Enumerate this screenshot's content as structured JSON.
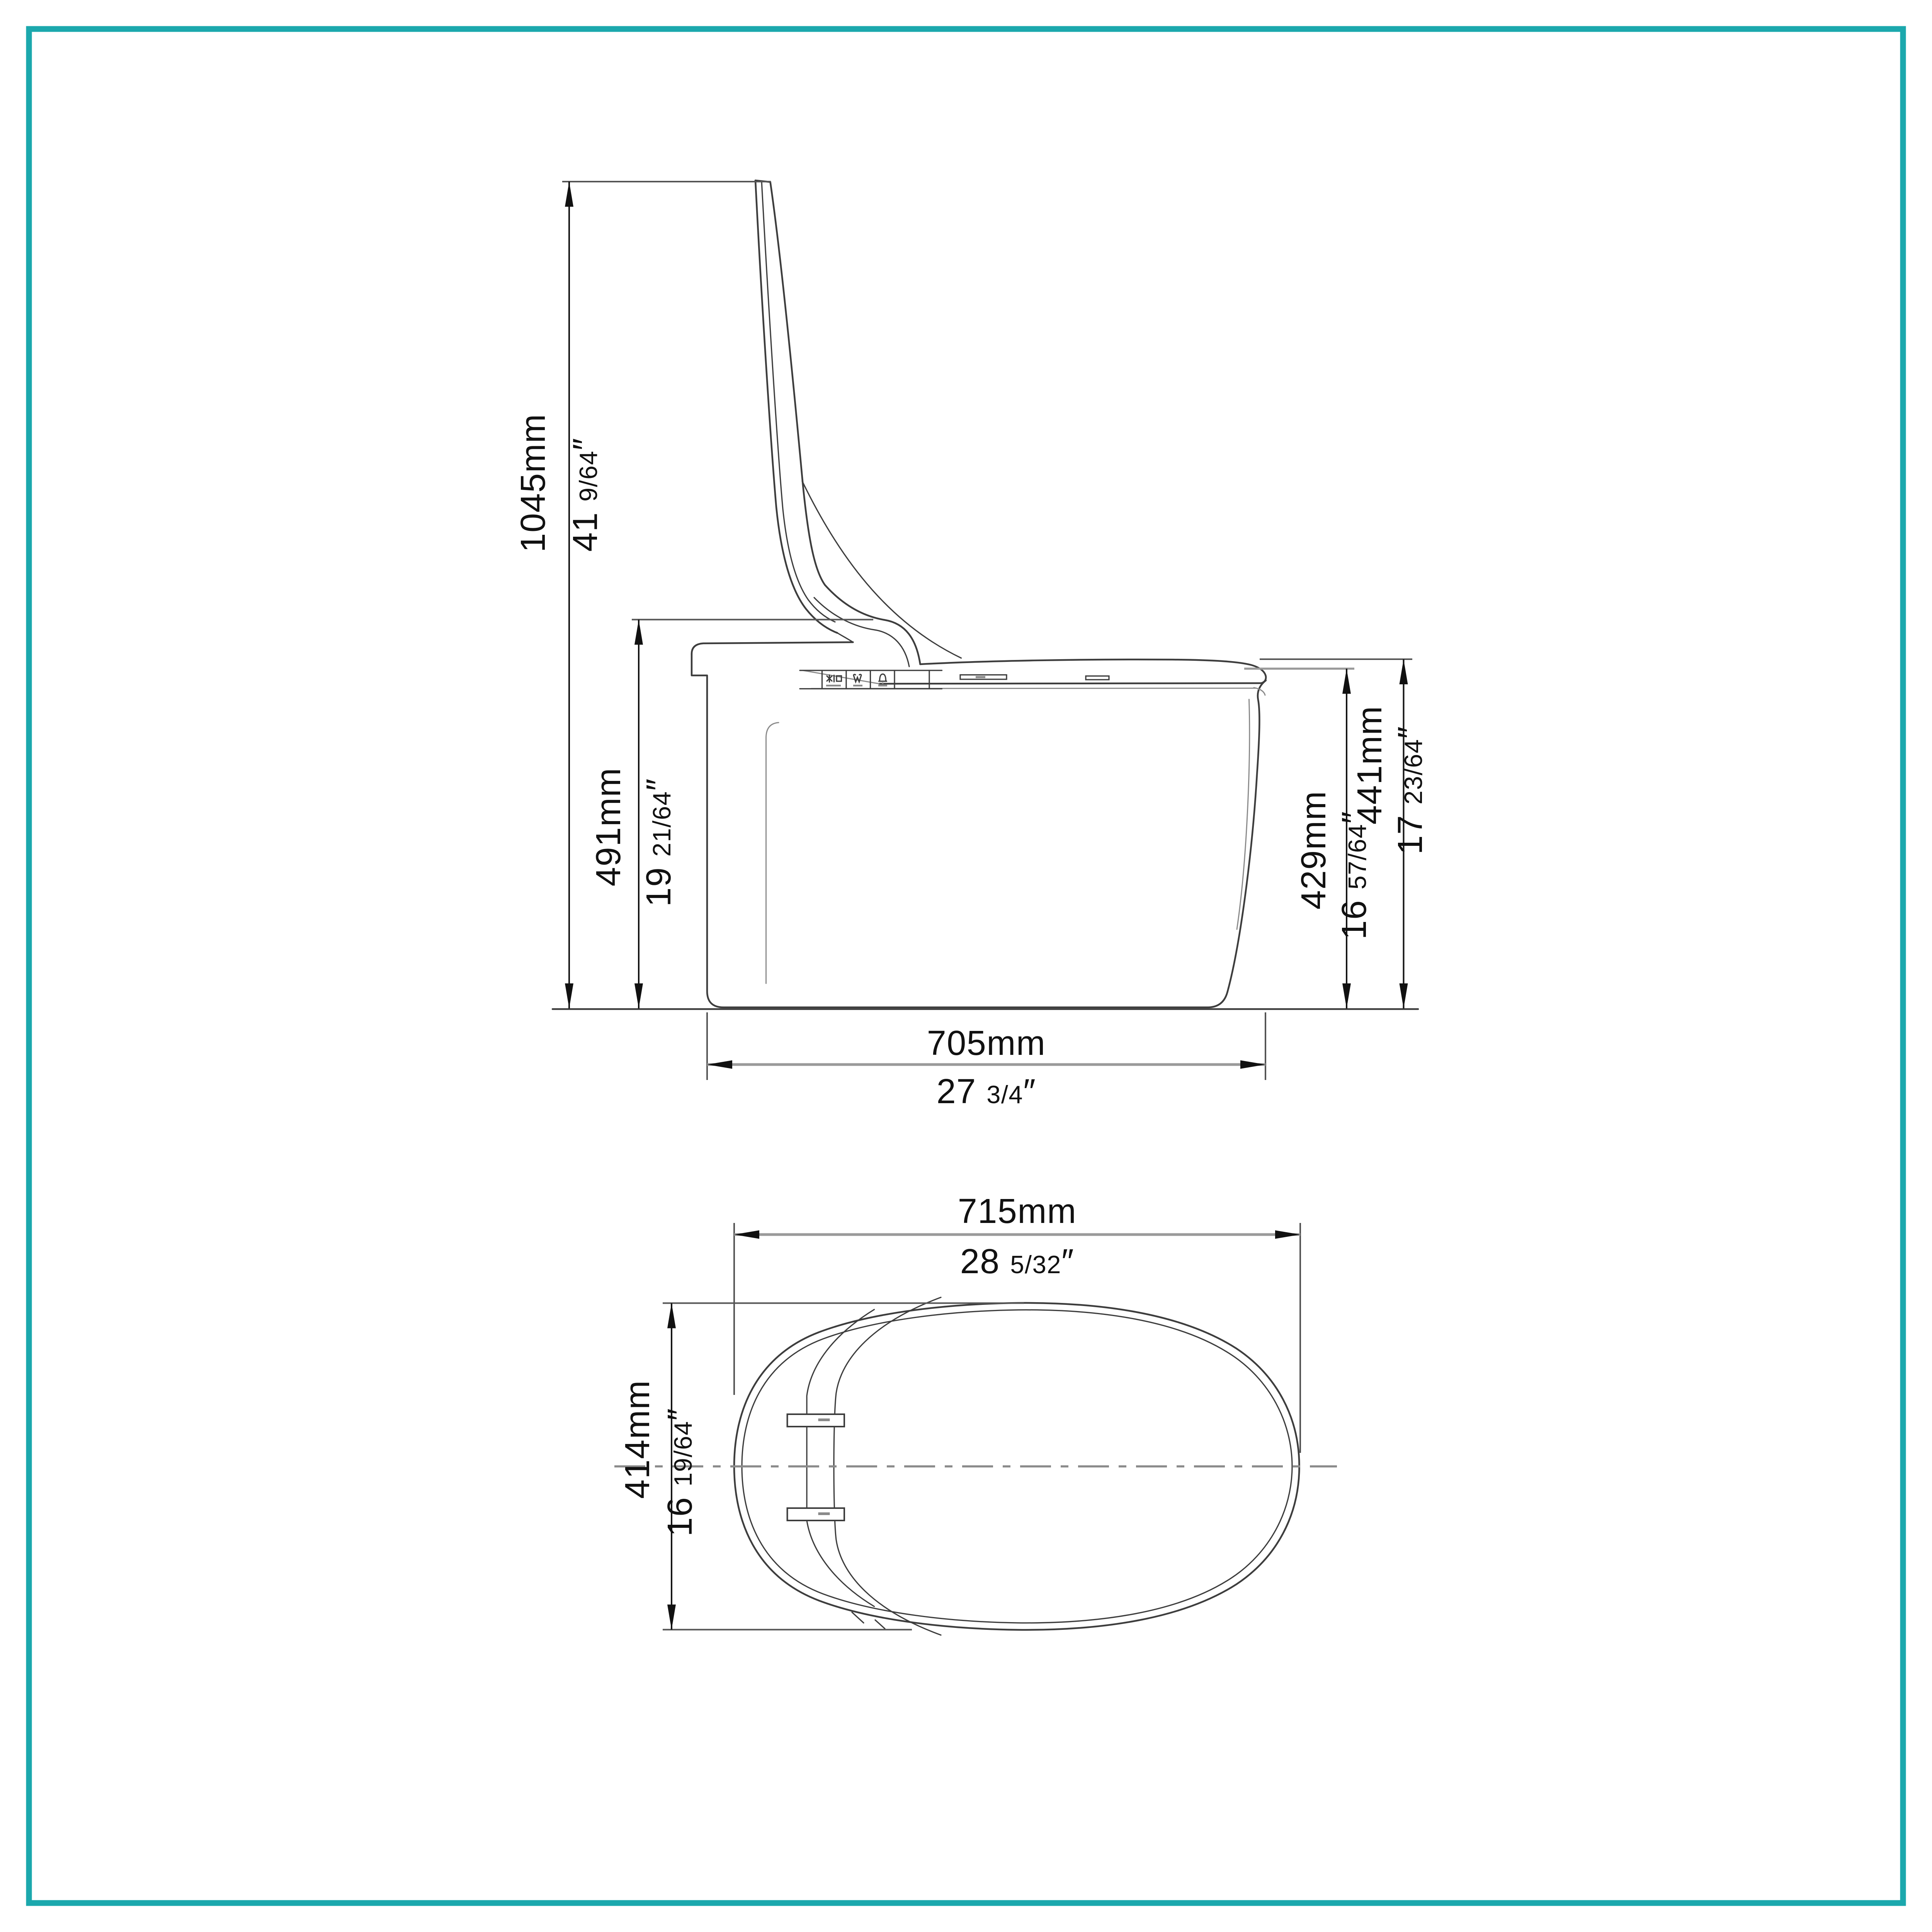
{
  "page": {
    "background": "#ffffff"
  },
  "colors": {
    "accent": "#1BA8AD",
    "outline": "#3d3d3d",
    "dim": "#161616",
    "gray": "#9a9a9a",
    "faint": "#8a8a8a"
  },
  "drawing": {
    "type": "technical-dimension-drawing",
    "subject": "one-piece smart bidet toilet, lid open",
    "views": [
      {
        "id": "side-elevation",
        "description": "side view with lid raised"
      },
      {
        "id": "top-plan",
        "description": "top view of seat and lid outline"
      }
    ]
  },
  "dims": {
    "d1045": {
      "mm": "1045mm",
      "in_main": "41 ",
      "in_frac": "9/64",
      "in_mark": "″"
    },
    "d491": {
      "mm": "491mm",
      "in_main": "19 ",
      "in_frac": "21/64",
      "in_mark": "″"
    },
    "d441": {
      "mm": "441mm",
      "in_main": "17 ",
      "in_frac": "23/64",
      "in_mark": "″"
    },
    "d429": {
      "mm": "429mm",
      "in_main": "16 ",
      "in_frac": "57/64",
      "in_mark": "″"
    },
    "d705": {
      "mm": "705mm",
      "in_main": "27 ",
      "in_frac": "3/4",
      "in_mark": "″"
    },
    "d715": {
      "mm": "715mm",
      "in_main": "28 ",
      "in_frac": "5/32",
      "in_mark": "″"
    },
    "d414": {
      "mm": "414mm",
      "in_main": "16 ",
      "in_frac": "19/64",
      "in_mark": "″"
    }
  },
  "icons": {
    "panel": [
      {
        "name": "wash-power-icon"
      },
      {
        "name": "spray-wash-icon"
      },
      {
        "name": "dryer-icon"
      }
    ]
  }
}
